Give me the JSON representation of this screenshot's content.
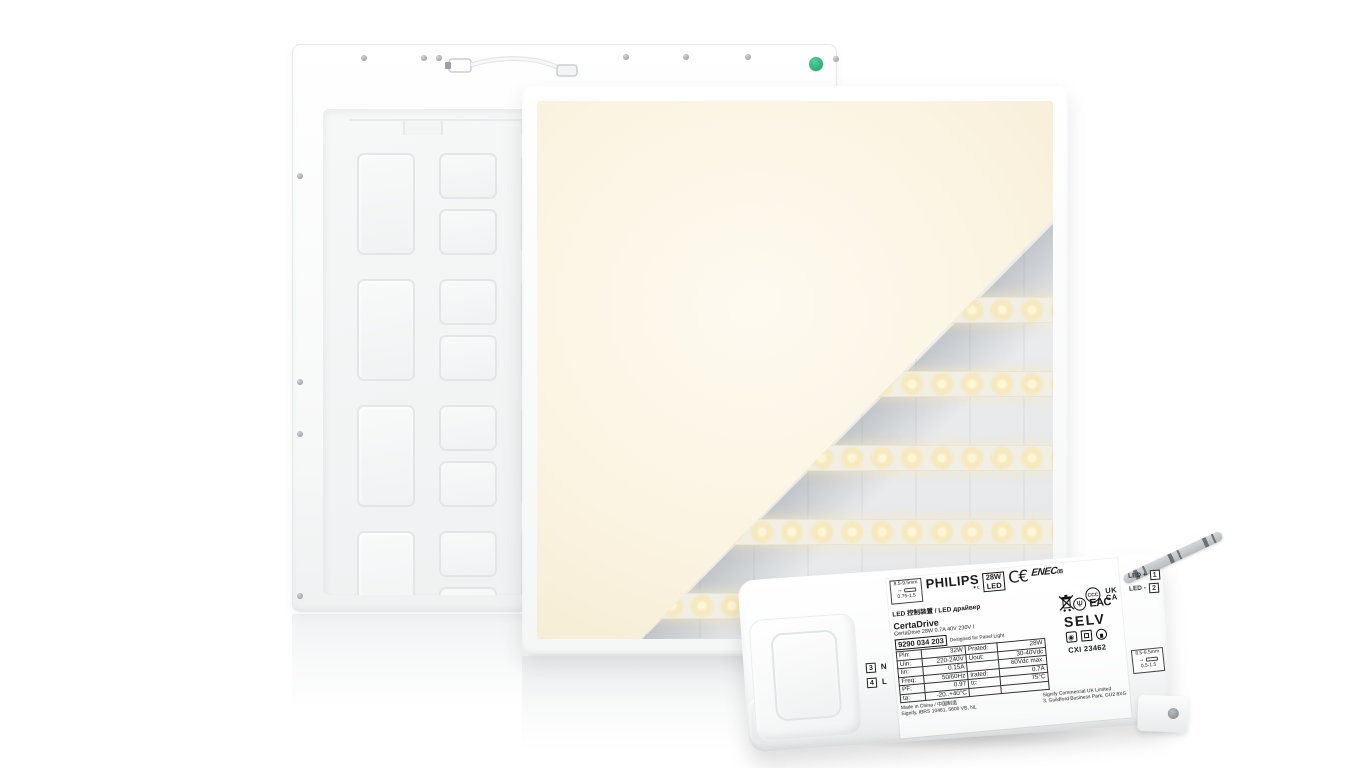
{
  "scene": {
    "background": "#ffffff"
  },
  "colors": {
    "panel_glow": "#fbf4e2",
    "led_dot_warm": "#f6e5ad",
    "cutaway_gray": "#e8eaec",
    "indicator_green": "#2eb47c"
  },
  "back_panel": {
    "indicator_dot": "green-qc-sticker"
  },
  "driver": {
    "brand": "PHILIPS",
    "brand_sub": "✶c",
    "badge_power": "28W",
    "badge_led": "LED",
    "marks": {
      "ce": "C€",
      "enec": "ENEC",
      "enec_num": "05",
      "ccc": "CCC",
      "ukca1": "UK",
      "ukca2": "CA",
      "eac": "EAC",
      "selv": "SELV"
    },
    "line_cnru": "LED 控制装置 / LED драйвер",
    "family": "CertaDrive",
    "subtitle": "CertaDrive 28W 0.7A 40V 230V I",
    "part_number": "9290 034 203",
    "designed_for": "Designed for Panel Light",
    "cxi": "CXI 23462",
    "spec": {
      "rows": [
        {
          "lk": "Pin:",
          "lv": "32W",
          "rk": "Prated:",
          "rv": "28W"
        },
        {
          "lk": "Uin:",
          "lv": "220-240V",
          "rk": "Uout:",
          "rv": "30-40Vdc"
        },
        {
          "lk": "Iin:",
          "lv": "0.15A",
          "rk": "",
          "rv": "60Vdc max."
        },
        {
          "lk": "Freq:",
          "lv": "50/60Hz",
          "rk": "Irated:",
          "rv": "0.7A"
        },
        {
          "lk": "PF:",
          "lv": "0.97",
          "rk": "tc:",
          "rv": "75°C"
        },
        {
          "lk": "ta:",
          "lv": "-20..+40°C",
          "rk": "",
          "rv": ""
        }
      ]
    },
    "terminals": [
      {
        "num": "3",
        "label": "N"
      },
      {
        "num": "4",
        "label": "L"
      }
    ],
    "outputs": [
      {
        "label": "LED +",
        "num": "1"
      },
      {
        "label": "LED -",
        "num": "2"
      }
    ],
    "made_in": "Made in China / 中国制造",
    "address_nl": "Signify, IBRS 10461, 5600 VB, NL",
    "address_uk1": "Signify Commercial UK Limited",
    "address_uk2": "3, Guildford Business Park, GU2 8XG",
    "wire_left": {
      "top": "8.5-9.5mm",
      "bottom": "0.75-1.5"
    },
    "wire_right": {
      "top": "8.5-9.5mm",
      "bottom": "0.5-1.5"
    }
  }
}
